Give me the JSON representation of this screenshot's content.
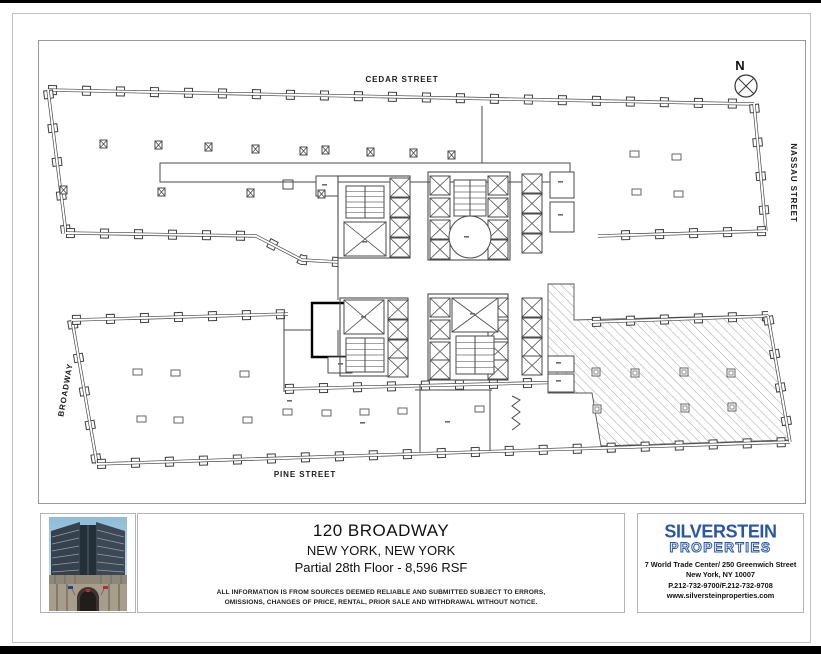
{
  "plan": {
    "streets": {
      "top": "CEDAR STREET",
      "right": "NASSAU STREET",
      "left": "BROADWAY",
      "bottom": "PINE STREET"
    },
    "north_label": "N"
  },
  "title_block": {
    "building": "120 BROADWAY",
    "city": "NEW YORK, NEW YORK",
    "space": "Partial 28th Floor - 8,596 RSF",
    "disclaimer_line1": "ALL INFORMATION IS FROM SOURCES DEEMED RELIABLE AND SUBMITTED SUBJECT TO ERRORS,",
    "disclaimer_line2": "OMISSIONS, CHANGES OF PRICE, RENTAL, PRIOR SALE AND WITHDRAWAL WITHOUT NOTICE."
  },
  "broker": {
    "logo_line1": "SILVERSTEIN",
    "logo_line2": "PROPERTIES",
    "address_line1": "7 World Trade Center/ 250 Greenwich Street",
    "address_line2": "New York, NY 10007",
    "phone_line": "P.212-732-9700/F.212-732-9708",
    "website": "www.silversteinproperties.com",
    "brand_color": "#2a57a5"
  }
}
